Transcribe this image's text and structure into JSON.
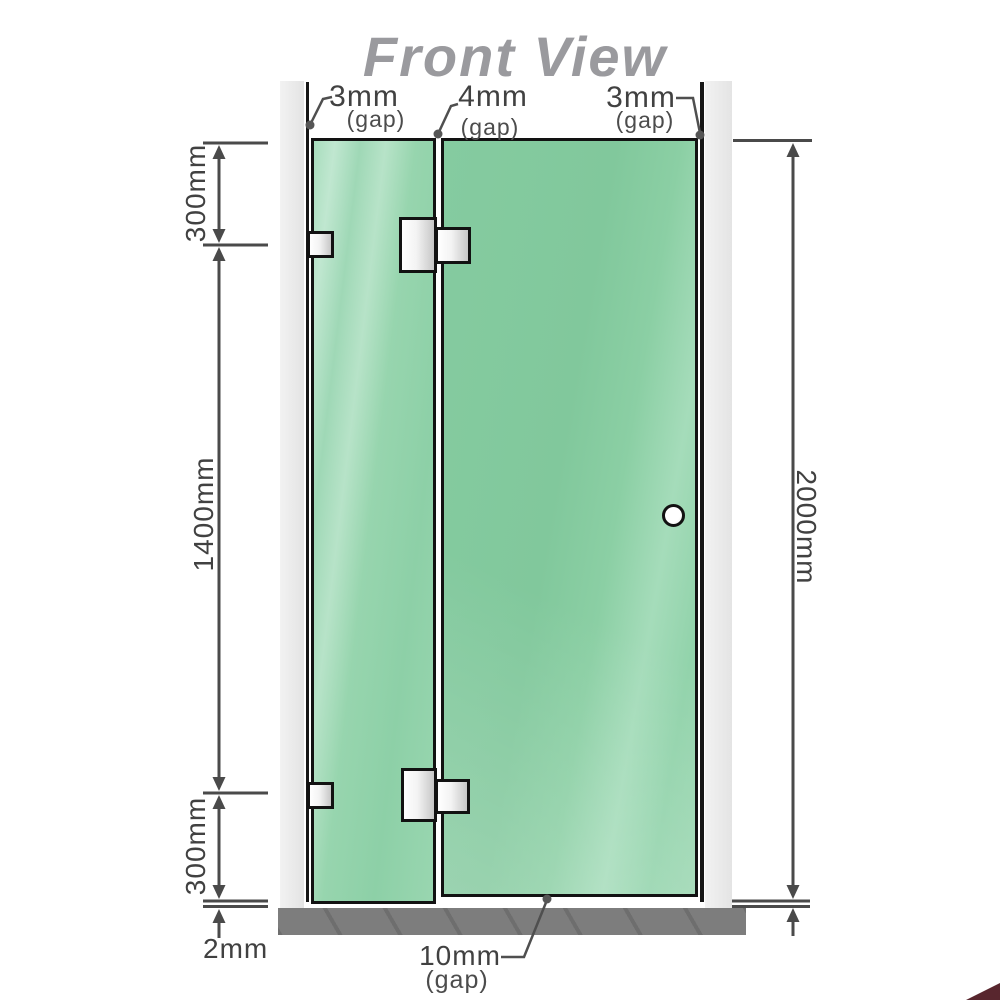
{
  "title": "Front View",
  "top_annotations": {
    "left_gap": {
      "value": "3mm",
      "label": "(gap)"
    },
    "middle_gap": {
      "value": "4mm",
      "label": "(gap)"
    },
    "right_gap": {
      "value": "3mm",
      "label": "(gap)"
    }
  },
  "bottom_annotations": {
    "floor_gap": {
      "value": "2mm"
    },
    "door_gap": {
      "value": "10mm",
      "label": "(gap)"
    }
  },
  "dimensions": {
    "top_section": "300mm",
    "middle_section": "1400mm",
    "bottom_section": "300mm",
    "total_height": "2000mm"
  },
  "colors": {
    "glass_green": "#8ed1a8",
    "frame_black": "#141414",
    "dimension_gray": "#4a4a4a",
    "title_gray": "#9a9a9e",
    "wall_channel_gray": "#ebebeb",
    "floor_gray": "#7d7d7d",
    "hardware_silver": "#e8e8e8"
  }
}
